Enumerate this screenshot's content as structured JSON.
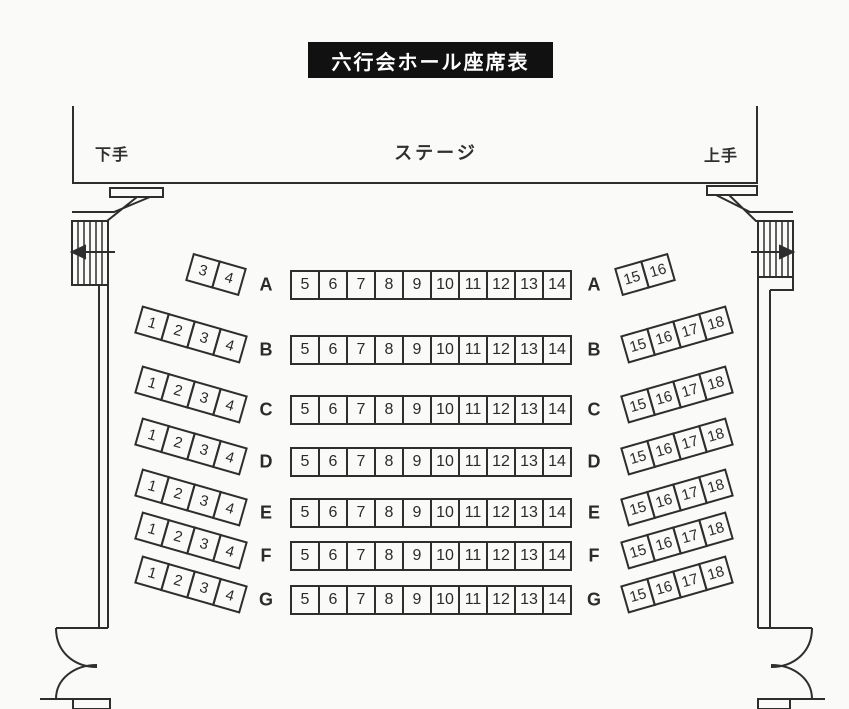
{
  "title": "六行会ホール座席表",
  "stage": {
    "label": "ステージ",
    "shimote_label": "下手",
    "kamite_label": "上手"
  },
  "rows": [
    {
      "letter": "A",
      "left_seats": [
        "3",
        "4"
      ],
      "center_seats": [
        "5",
        "6",
        "7",
        "8",
        "9",
        "10",
        "11",
        "12",
        "13",
        "14"
      ],
      "right_seats": [
        "15",
        "16"
      ]
    },
    {
      "letter": "B",
      "left_seats": [
        "1",
        "2",
        "3",
        "4"
      ],
      "center_seats": [
        "5",
        "6",
        "7",
        "8",
        "9",
        "10",
        "11",
        "12",
        "13",
        "14"
      ],
      "right_seats": [
        "15",
        "16",
        "17",
        "18"
      ]
    },
    {
      "letter": "C",
      "left_seats": [
        "1",
        "2",
        "3",
        "4"
      ],
      "center_seats": [
        "5",
        "6",
        "7",
        "8",
        "9",
        "10",
        "11",
        "12",
        "13",
        "14"
      ],
      "right_seats": [
        "15",
        "16",
        "17",
        "18"
      ]
    },
    {
      "letter": "D",
      "left_seats": [
        "1",
        "2",
        "3",
        "4"
      ],
      "center_seats": [
        "5",
        "6",
        "7",
        "8",
        "9",
        "10",
        "11",
        "12",
        "13",
        "14"
      ],
      "right_seats": [
        "15",
        "16",
        "17",
        "18"
      ]
    },
    {
      "letter": "E",
      "left_seats": [
        "1",
        "2",
        "3",
        "4"
      ],
      "center_seats": [
        "5",
        "6",
        "7",
        "8",
        "9",
        "10",
        "11",
        "12",
        "13",
        "14"
      ],
      "right_seats": [
        "15",
        "16",
        "17",
        "18"
      ]
    },
    {
      "letter": "F",
      "left_seats": [
        "1",
        "2",
        "3",
        "4"
      ],
      "center_seats": [
        "5",
        "6",
        "7",
        "8",
        "9",
        "10",
        "11",
        "12",
        "13",
        "14"
      ],
      "right_seats": [
        "15",
        "16",
        "17",
        "18"
      ]
    },
    {
      "letter": "G",
      "left_seats": [
        "1",
        "2",
        "3",
        "4"
      ],
      "center_seats": [
        "5",
        "6",
        "7",
        "8",
        "9",
        "10",
        "11",
        "12",
        "13",
        "14"
      ],
      "right_seats": [
        "15",
        "16",
        "17",
        "18"
      ]
    }
  ],
  "icons": {
    "left_stairs_arrow": "arrow-left",
    "right_stairs_arrow": "arrow-right"
  },
  "colors": {
    "line": "#2e2e2e",
    "banner_bg": "#111111",
    "banner_text": "#ffffff",
    "paper": "#fafaf8"
  }
}
